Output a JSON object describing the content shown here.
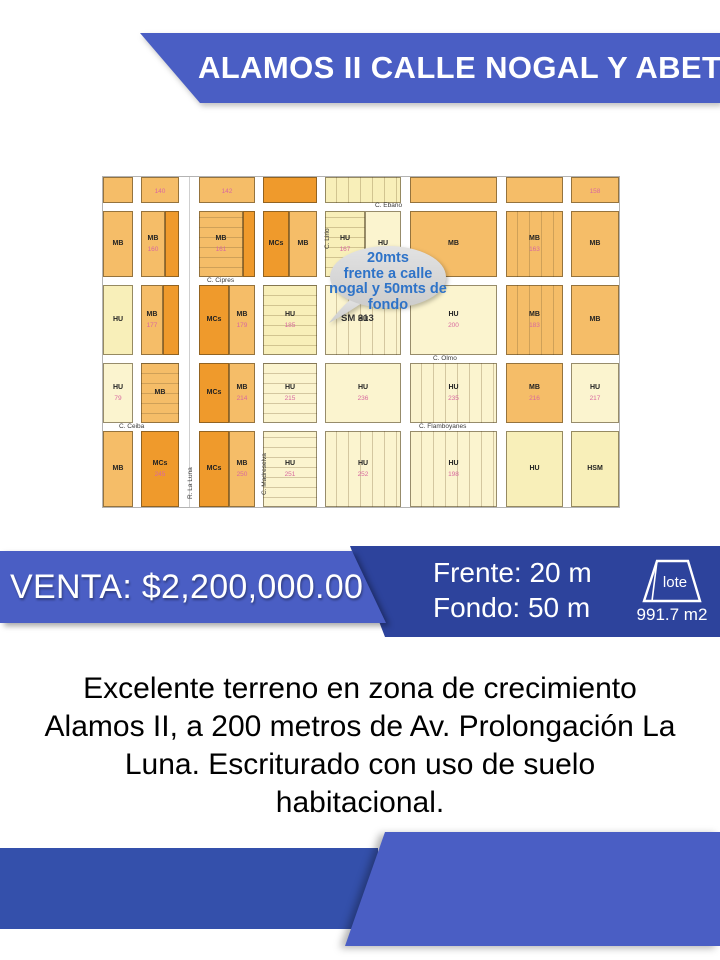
{
  "header": {
    "title": "ALAMOS II CALLE NOGAL Y ABETO"
  },
  "colors": {
    "banner_blue": "#4a5ec4",
    "panel_dark_blue": "#2d439c",
    "bottom_rect_blue": "#3450ab",
    "bubble_fill": "#d7d7d7",
    "bubble_text_blue": "#2e73c8",
    "map_dark_orange": "#ef9a2c",
    "map_medium_orange": "#f5bd68",
    "map_light_yellow": "#f8efb9",
    "map_cream": "#fbf4cf",
    "lot_number_pink": "#d9699f"
  },
  "map": {
    "bubble": {
      "lines": [
        "20mts",
        "frente a calle",
        "nogal y 50mts de",
        "fondo"
      ]
    },
    "sector_label": "SM 313",
    "streets": [
      {
        "t": "C. Cipres",
        "x": 104,
        "y": 100,
        "v": false
      },
      {
        "t": "C. Ebano",
        "x": 272,
        "y": 25,
        "v": false
      },
      {
        "t": "C. Olmo",
        "x": 330,
        "y": 178,
        "v": false
      },
      {
        "t": "C. Flamboyanes",
        "x": 316,
        "y": 246,
        "v": false
      },
      {
        "t": "C. Ceiba",
        "x": 16,
        "y": 246,
        "v": false
      },
      {
        "t": "C. Lirio",
        "x": 221,
        "y": 72,
        "v": true
      },
      {
        "t": "R. La Luna",
        "x": 84,
        "y": 322,
        "v": true
      },
      {
        "t": "C. Madreselva",
        "x": 158,
        "y": 318,
        "v": true
      }
    ],
    "blocks": [
      {
        "x": 0,
        "y": 0,
        "w": 30,
        "h": 26,
        "c": "mo"
      },
      {
        "x": 38,
        "y": 0,
        "w": 38,
        "h": 26,
        "c": "mo",
        "n": "140"
      },
      {
        "x": 96,
        "y": 0,
        "w": 56,
        "h": 26,
        "c": "mo",
        "n": "142"
      },
      {
        "x": 160,
        "y": 0,
        "w": 54,
        "h": 26,
        "c": "do"
      },
      {
        "x": 222,
        "y": 0,
        "w": 76,
        "h": 26,
        "c": "ly",
        "s": "v"
      },
      {
        "x": 307,
        "y": 0,
        "w": 87,
        "h": 26,
        "c": "mo"
      },
      {
        "x": 403,
        "y": 0,
        "w": 57,
        "h": 26,
        "c": "mo"
      },
      {
        "x": 468,
        "y": 0,
        "w": 48,
        "h": 26,
        "c": "mo",
        "n": "158"
      },
      {
        "x": 0,
        "y": 34,
        "w": 30,
        "h": 66,
        "c": "mo",
        "l": "MB"
      },
      {
        "x": 38,
        "y": 34,
        "w": 24,
        "h": 66,
        "c": "mo",
        "l": "MB",
        "n": "160"
      },
      {
        "x": 62,
        "y": 34,
        "w": 14,
        "h": 66,
        "c": "do"
      },
      {
        "x": 96,
        "y": 34,
        "w": 44,
        "h": 66,
        "c": "mo",
        "l": "MB",
        "n": "161",
        "s": "h"
      },
      {
        "x": 140,
        "y": 34,
        "w": 12,
        "h": 66,
        "c": "do"
      },
      {
        "x": 160,
        "y": 34,
        "w": 26,
        "h": 66,
        "c": "do",
        "l": "MCs"
      },
      {
        "x": 186,
        "y": 34,
        "w": 28,
        "h": 66,
        "c": "mo",
        "l": "MB"
      },
      {
        "x": 222,
        "y": 34,
        "w": 40,
        "h": 66,
        "c": "ly",
        "l": "HU",
        "n": "167",
        "s": "h"
      },
      {
        "x": 262,
        "y": 34,
        "w": 36,
        "h": 66,
        "c": "cr",
        "l": "HU"
      },
      {
        "x": 307,
        "y": 34,
        "w": 87,
        "h": 66,
        "c": "mo",
        "l": "MB"
      },
      {
        "x": 403,
        "y": 34,
        "w": 57,
        "h": 66,
        "c": "mo",
        "l": "MB",
        "n": "163",
        "s": "v"
      },
      {
        "x": 468,
        "y": 34,
        "w": 48,
        "h": 66,
        "c": "mo",
        "l": "MB"
      },
      {
        "x": 0,
        "y": 108,
        "w": 30,
        "h": 70,
        "c": "ly",
        "l": "HU"
      },
      {
        "x": 38,
        "y": 108,
        "w": 22,
        "h": 70,
        "c": "mo",
        "l": "MB",
        "n": "177"
      },
      {
        "x": 60,
        "y": 108,
        "w": 16,
        "h": 70,
        "c": "do"
      },
      {
        "x": 96,
        "y": 108,
        "w": 30,
        "h": 70,
        "c": "do",
        "l": "MCs"
      },
      {
        "x": 126,
        "y": 108,
        "w": 26,
        "h": 70,
        "c": "mo",
        "l": "MB",
        "n": "179"
      },
      {
        "x": 160,
        "y": 108,
        "w": 54,
        "h": 70,
        "c": "ly",
        "l": "HU",
        "n": "185",
        "s": "h"
      },
      {
        "x": 222,
        "y": 108,
        "w": 76,
        "h": 70,
        "c": "cr",
        "l": "HU",
        "s": "v"
      },
      {
        "x": 307,
        "y": 108,
        "w": 87,
        "h": 70,
        "c": "cr",
        "l": "HU",
        "n": "200"
      },
      {
        "x": 403,
        "y": 108,
        "w": 57,
        "h": 70,
        "c": "mo",
        "l": "MB",
        "n": "183",
        "s": "v"
      },
      {
        "x": 468,
        "y": 108,
        "w": 48,
        "h": 70,
        "c": "mo",
        "l": "MB"
      },
      {
        "x": 0,
        "y": 186,
        "w": 30,
        "h": 60,
        "c": "cr",
        "l": "HU",
        "n": "79"
      },
      {
        "x": 38,
        "y": 186,
        "w": 38,
        "h": 60,
        "c": "mo",
        "l": "MB",
        "s": "h"
      },
      {
        "x": 96,
        "y": 186,
        "w": 30,
        "h": 60,
        "c": "do",
        "l": "MCs"
      },
      {
        "x": 126,
        "y": 186,
        "w": 26,
        "h": 60,
        "c": "mo",
        "l": "MB",
        "n": "214"
      },
      {
        "x": 160,
        "y": 186,
        "w": 54,
        "h": 60,
        "c": "cr",
        "l": "HU",
        "n": "215",
        "s": "h"
      },
      {
        "x": 222,
        "y": 186,
        "w": 76,
        "h": 60,
        "c": "cr",
        "l": "HU",
        "n": "236"
      },
      {
        "x": 307,
        "y": 186,
        "w": 87,
        "h": 60,
        "c": "cr",
        "l": "HU",
        "n": "235",
        "s": "v"
      },
      {
        "x": 403,
        "y": 186,
        "w": 57,
        "h": 60,
        "c": "mo",
        "l": "MB",
        "n": "216"
      },
      {
        "x": 468,
        "y": 186,
        "w": 48,
        "h": 60,
        "c": "cr",
        "l": "HU",
        "n": "217"
      },
      {
        "x": 0,
        "y": 254,
        "w": 30,
        "h": 76,
        "c": "mo",
        "l": "MB"
      },
      {
        "x": 38,
        "y": 254,
        "w": 38,
        "h": 76,
        "c": "do",
        "l": "MCs",
        "n": "245"
      },
      {
        "x": 96,
        "y": 254,
        "w": 30,
        "h": 76,
        "c": "do",
        "l": "MCs"
      },
      {
        "x": 126,
        "y": 254,
        "w": 26,
        "h": 76,
        "c": "mo",
        "l": "MB",
        "n": "250"
      },
      {
        "x": 160,
        "y": 254,
        "w": 54,
        "h": 76,
        "c": "cr",
        "l": "HU",
        "n": "251",
        "s": "h"
      },
      {
        "x": 222,
        "y": 254,
        "w": 76,
        "h": 76,
        "c": "cr",
        "l": "HU",
        "n": "252",
        "s": "v"
      },
      {
        "x": 307,
        "y": 254,
        "w": 87,
        "h": 76,
        "c": "cr",
        "l": "HU",
        "n": "198",
        "s": "v"
      },
      {
        "x": 403,
        "y": 254,
        "w": 57,
        "h": 76,
        "c": "ly",
        "l": "HU"
      },
      {
        "x": 468,
        "y": 254,
        "w": 48,
        "h": 76,
        "c": "ly",
        "l": "HSM"
      }
    ]
  },
  "price": {
    "label": "VENTA: $2,200,000.00"
  },
  "dimensions": {
    "frente": "Frente: 20 m",
    "fondo": "Fondo: 50 m"
  },
  "lot": {
    "icon_label": "lote",
    "area": "991.7 m2"
  },
  "description": {
    "lines": [
      "Excelente terreno en zona de crecimiento",
      "Alamos II, a 200 metros de Av. Prolongación La",
      "Luna. Escriturado con uso de suelo",
      "habitacional."
    ]
  }
}
